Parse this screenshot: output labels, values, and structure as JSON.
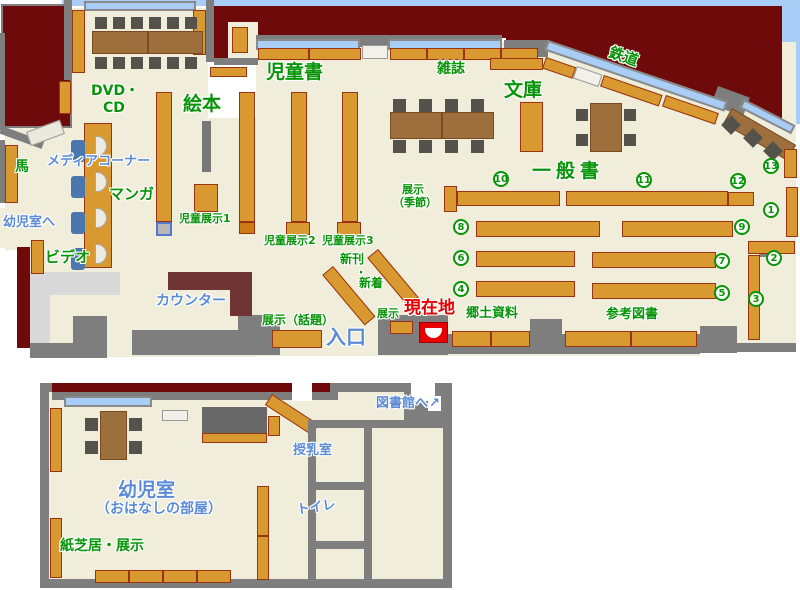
{
  "palette": {
    "floor": "#F0EDDB",
    "wall": "#7E7E7E",
    "outside_dark_red": "#6E0A0A",
    "outside_sky": "#A8CEF8",
    "shelf_orange": "#D89A30",
    "shelf_border": "#993311",
    "window_blue": "#A8CEF8",
    "table_brown": "#9C6F3C",
    "chair_gray": "#55514B",
    "counter_maroon": "#6F3535",
    "media_chair_blue": "#4A77AD",
    "light_gray": "#D9D9D9",
    "green_text": "#089408",
    "blue_text": "#5B8BD6",
    "red_text": "#E60000"
  },
  "labels": {
    "ehon": "絵本",
    "jidosho": "児童書",
    "zasshi": "雑誌",
    "bunko": "文庫",
    "tetsudo": "鉄道",
    "ippansho": "一般書",
    "dvd_line1": "DVD・",
    "dvd_line2": "CD",
    "media_corner": "メディアコーナー",
    "uma": "馬",
    "manga": "マンガ",
    "yojishitsu_e": "幼児室へ",
    "video": "ビデオ",
    "counter": "カウンター",
    "jido_tenji1": "児童展示1",
    "jido_tenji2": "児童展示2",
    "jido_tenji3": "児童展示3",
    "shinkan": "新刊",
    "nakaguro": "・",
    "shinchaku": "新着",
    "tenji_wadai": "展示（話題）",
    "iriguchi": "入口",
    "tenji": "展示",
    "genzaichi": "現在地",
    "kyodo_shiryo": "郷土資料",
    "sanko_tosho": "参考図書",
    "tenji_kisetsu_line1": "展示",
    "tenji_kisetsu_line2": "（季節）",
    "toshokan_e": "図書館へ",
    "toshokan_arrow": "↗",
    "junyushitsu": "授乳室",
    "toire": "トイレ",
    "yojishitsu": "幼児室",
    "ohanashi": "（おはなしの部屋）",
    "kamishibai": "紙芝居・展示"
  },
  "numbers": [
    "1",
    "2",
    "3",
    "4",
    "5",
    "6",
    "7",
    "8",
    "9",
    "10",
    "11",
    "12",
    "13"
  ]
}
